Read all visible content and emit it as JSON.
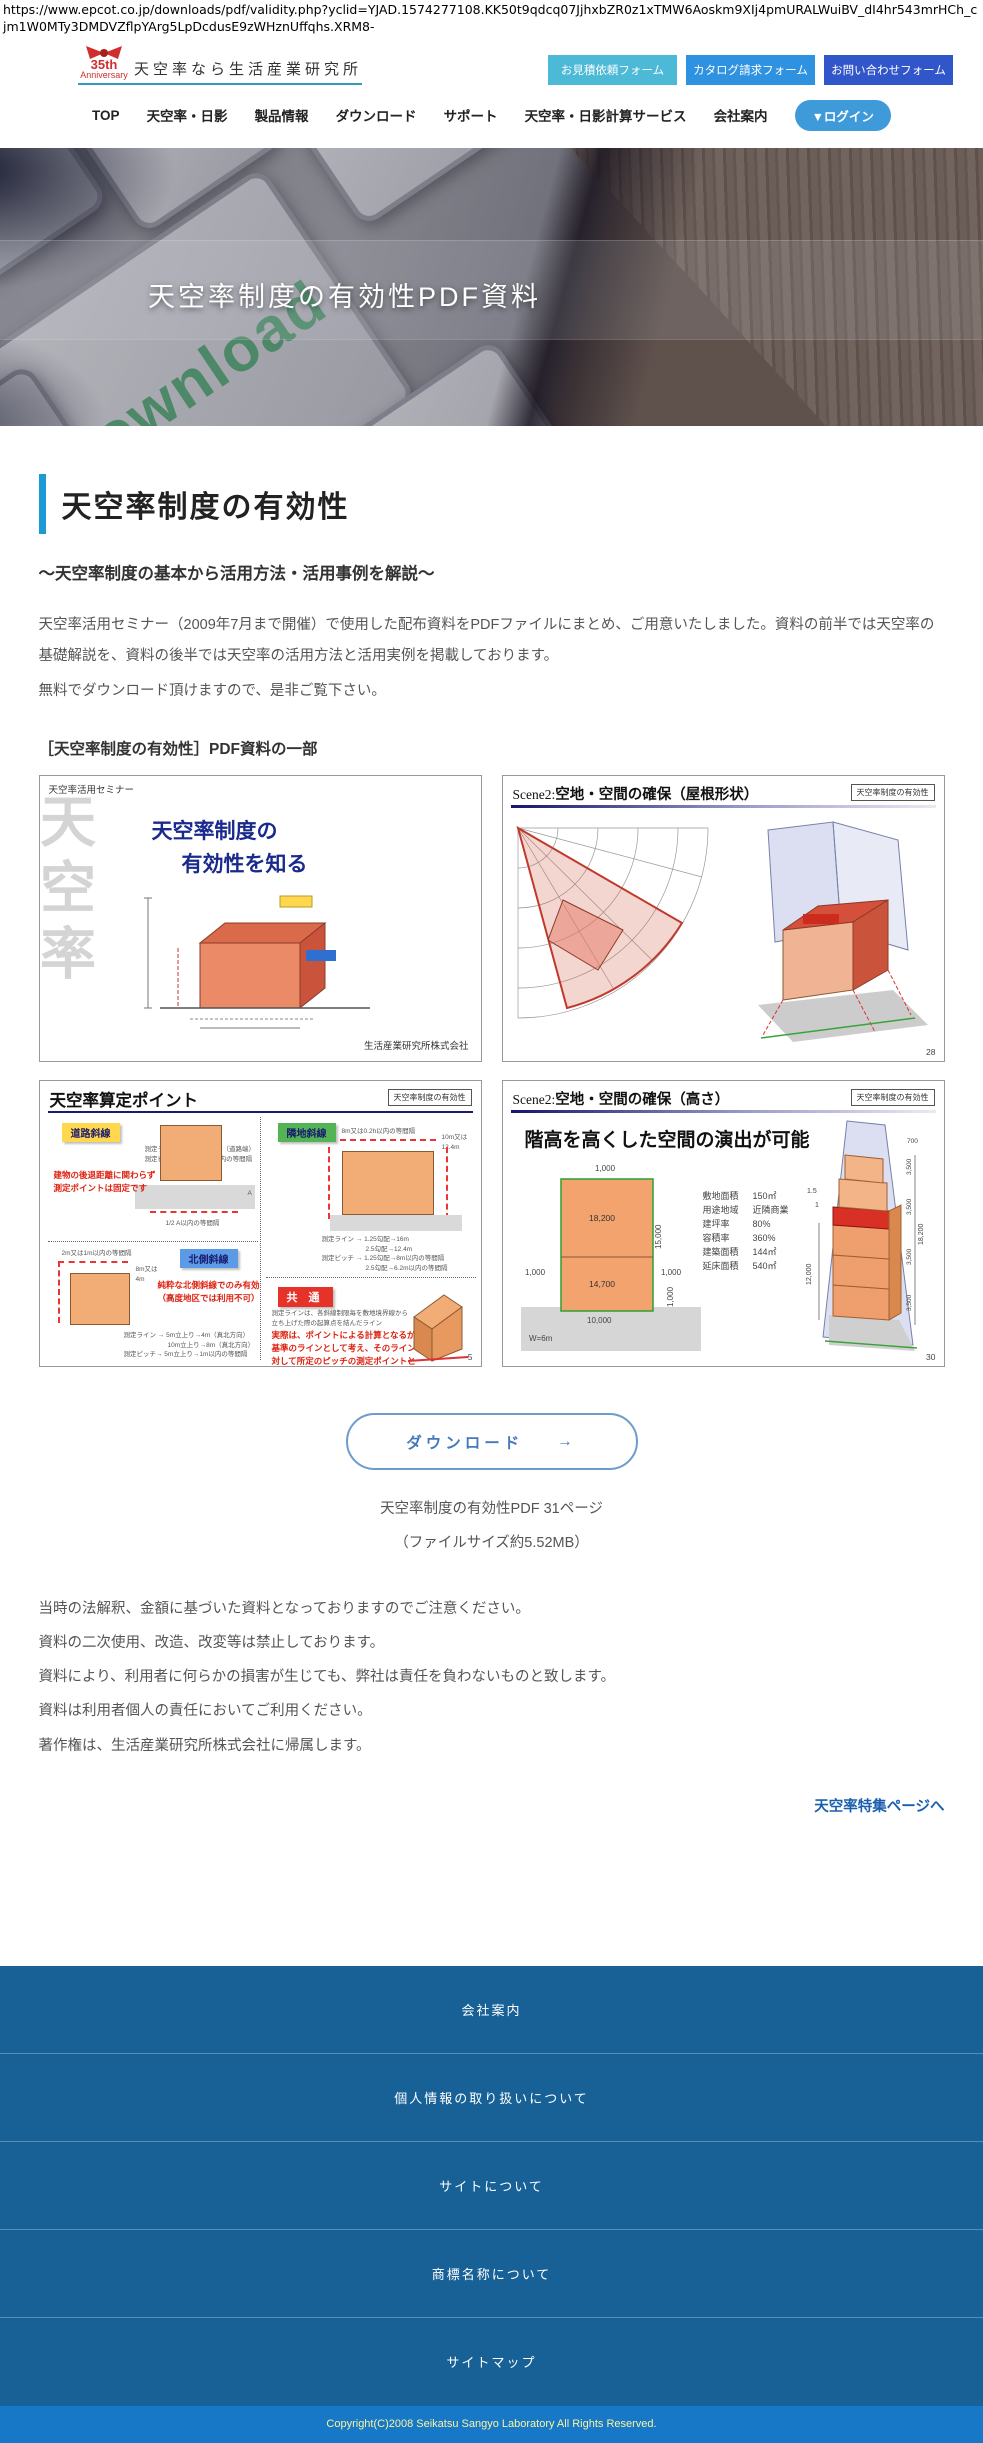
{
  "browser": {
    "url_text": "https://www.epcot.co.jp/downloads/pdf/validity.php?yclid=YJAD.1574277108.KK50t9qdcq07JjhxbZR0z1xTMW6Aoskm9XIj4pmURALWuiBV_dI4hr543mrHCh_cjm1W0MTy3DMDVZflpYArg5LpDcdusE9zWHznUffqhs.XRM8-"
  },
  "header": {
    "logo_badge_line1": "35th",
    "logo_badge_line2": "Anniversary",
    "logo_text": "天空率なら生活産業研究所",
    "buttons": [
      {
        "label": "お見積依頼フォーム",
        "color": "#4cb9d6"
      },
      {
        "label": "カタログ請求フォーム",
        "color": "#2f92e0"
      },
      {
        "label": "お問い合わせフォーム",
        "color": "#3156c9"
      }
    ]
  },
  "nav": {
    "items": [
      {
        "label": "TOP"
      },
      {
        "label": "天空率・日影"
      },
      {
        "label": "製品情報"
      },
      {
        "label": "ダウンロード"
      },
      {
        "label": "サポート"
      },
      {
        "label": "天空率・日影計算サービス"
      },
      {
        "label": "会社案内"
      }
    ],
    "login_label": "▼ログイン"
  },
  "hero": {
    "watermark": "Download",
    "title": "天空率制度の有効性PDF資料"
  },
  "main": {
    "heading": "天空率制度の有効性",
    "subtitle": "～天空率制度の基本から活用方法・活用事例を解説～",
    "paragraph1": "天空率活用セミナー（2009年7月まで開催）で使用した配布資料をPDFファイルにまとめ、ご用意いたしました。資料の前半では天空率の基礎解説を、資料の後半では天空率の活用方法と活用実例を掲載しております。",
    "paragraph2": "無料でダウンロード頂けますので、是非ご覧下さい。",
    "preview_label": "［天空率制度の有効性］PDF資料の一部"
  },
  "previews": {
    "panel1": {
      "header": "天空率活用セミナー",
      "watermark": "天空率",
      "title_line1": "天空率制度の",
      "title_line2": "有効性を知る",
      "company": "生活産業研究所株式会社"
    },
    "panel2": {
      "scene_prefix": "Scene2:",
      "title": "空地・空間の確保（屋根形状）",
      "badge": "天空率制度の有効性",
      "page": "28"
    },
    "panel3": {
      "title": "天空率算定ポイント",
      "badge": "天空率制度の有効性",
      "label_road": "道路斜線",
      "label_adjacent": "隣地斜線",
      "label_north": "北側斜線",
      "label_common": "共 通",
      "ann_road_1": "測定ライン→道路の反対側（道路端）",
      "ann_road_2": "測定ピッチ→道路幅／2以内の等間隔",
      "ann_road_bottom": "1/2 A以内の等間隔",
      "label_A": "A",
      "note_road_1": "建物の後退距離に関わらず",
      "note_road_2": "測定ポイントは固定です",
      "adj_top": "8m又は0.2h以内の等間隔",
      "adj_right_1": "10m又は",
      "adj_right_2": "12.4m",
      "adj_line_1": "測定ライン → 1.25勾配→16m",
      "adj_line_2": "2.5勾配→12.4m",
      "adj_line_3": "測定ピッチ → 1.25勾配→8m以内の等間隔",
      "adj_line_4": "2.5勾配→6.2m以内の等間隔",
      "north_top": "2m又は1m以内の等間隔",
      "north_right_1": "8m又は",
      "north_right_2": "4m",
      "label_N": "N",
      "note_north_1": "純粋な北側斜線でのみ有効",
      "note_north_2": "（高度地区では利用不可）",
      "north_line_1": "測定ライン → 5m立上り→4m（真北方向）",
      "north_line_2": "10m立上り→8m（真北方向）",
      "north_line_3": "測定ピッチ→ 5m立上り→1m以内の等間隔",
      "common_note_1": "測定ラインは、各斜線制限毎を敷地境界線から",
      "common_note_2": "立ち上げた際の起算点を結んだライン",
      "common_red_1": "実際は、ポイントによる計算となるが",
      "common_red_2": "基準のラインとして考え、そのラインに",
      "common_red_3": "対して所定のピッチの測定ポイントと",
      "common_red_4": "して捉えるとわかりやすい",
      "page": "5"
    },
    "panel4": {
      "scene_prefix": "Scene2:",
      "title": "空地・空間の確保（高さ）",
      "badge": "天空率制度の有効性",
      "headline": "階高を高くした空間の演出が可能",
      "specs": [
        {
          "k": "敷地面積",
          "v": "150㎡"
        },
        {
          "k": "用途地域",
          "v": "近隣商業"
        },
        {
          "k": "建坪率",
          "v": "80%"
        },
        {
          "k": "容積率",
          "v": "360%"
        },
        {
          "k": "建築面積",
          "v": "144㎡"
        },
        {
          "k": "延床面積",
          "v": "540㎡"
        }
      ],
      "plan": {
        "top": "1,000",
        "upper": "18,200",
        "side": "15,000",
        "left": "1,000",
        "lower": "14,700",
        "right": "1,000",
        "bottom": "10,000",
        "bottom_right": "1,000",
        "width_label": "W=6m"
      },
      "iso": {
        "height": "12,000",
        "total": "18,200",
        "floor": "3,500",
        "top": "700",
        "slope_a": "1.5",
        "slope_b": "1"
      },
      "page": "30"
    }
  },
  "download": {
    "button_label": "ダウンロード",
    "button_arrow": "→",
    "caption1": "天空率制度の有効性PDF 31ページ",
    "caption2": "（ファイルサイズ約5.52MB）"
  },
  "notes": [
    {
      "text": "当時の法解釈、金額に基づいた資料となっておりますのでご注意ください。"
    },
    {
      "text": "資料の二次使用、改造、改変等は禁止しております。"
    },
    {
      "text": "資料により、利用者に何らかの損害が生じても、弊社は責任を負わないものと致します。"
    },
    {
      "text": "資料は利用者個人の責任においてご利用ください。"
    },
    {
      "text": "著作権は、生活産業研究所株式会社に帰属します。"
    }
  ],
  "feature_link": "天空率特集ページへ",
  "footer": {
    "links": [
      {
        "label": "会社案内"
      },
      {
        "label": "個人情報の取り扱いについて"
      },
      {
        "label": "サイトについて"
      },
      {
        "label": "商標名称について"
      },
      {
        "label": "サイトマップ"
      }
    ],
    "copyright": "Copyright(C)2008 Seikatsu Sangyo Laboratory All Rights Reserved."
  },
  "colors": {
    "accent_blue": "#1b9ad5",
    "btn_estimate": "#4cb9d6",
    "btn_catalog": "#2f92e0",
    "btn_contact": "#3156c9",
    "login_pill": "#3e9ad8",
    "footer_bg": "#176197",
    "copyright_bg": "#1878c8",
    "copyright_text": "#faf3a0",
    "link_blue": "#1a5fae"
  }
}
